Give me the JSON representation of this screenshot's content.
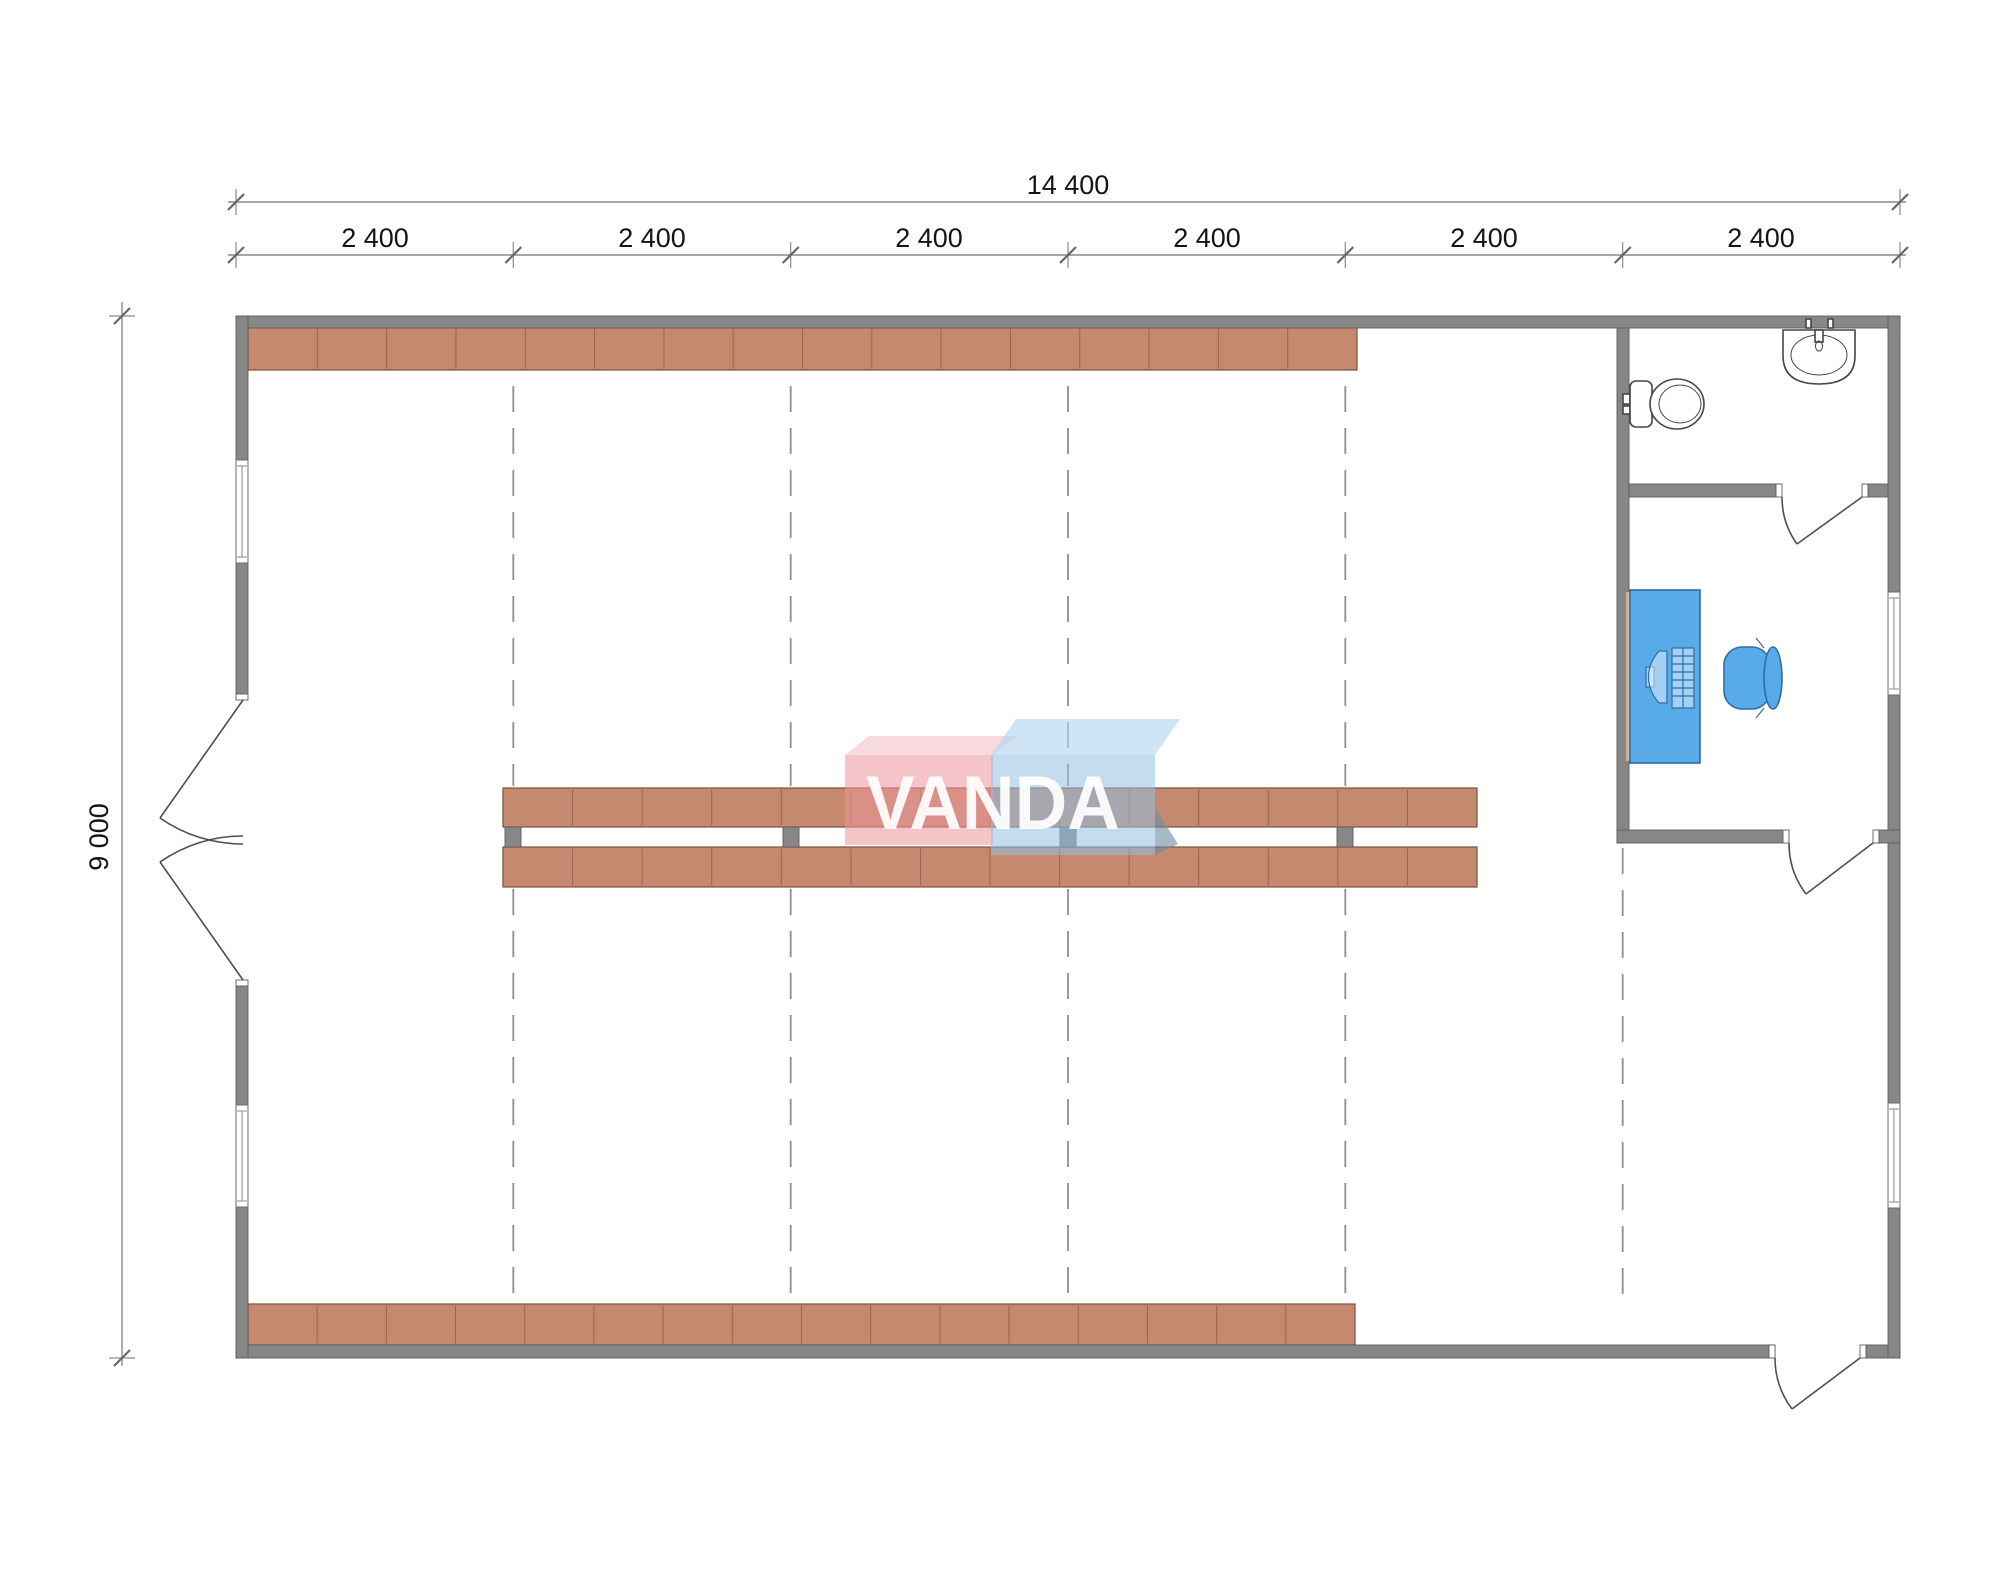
{
  "dimensions": {
    "overall_width_label": "14 400",
    "bay_labels": [
      "2 400",
      "2 400",
      "2 400",
      "2 400",
      "2 400",
      "2 400"
    ],
    "overall_height_label": "9 000"
  },
  "watermark": {
    "text": "VANDA"
  },
  "colors": {
    "wall": "#878787",
    "wall_outline": "#5d5d5d",
    "shelf_fill": "#c4896e",
    "shelf_outline": "#7d523a",
    "shelf_divider": "#9a644b",
    "furniture_blue": "#58aae9",
    "furniture_blue_outline": "#2f6da6",
    "gridline": "#909090",
    "dimension_line": "#8a8a8a",
    "dimension_text": "#141414",
    "fixture_outline": "#454545",
    "watermark_pink": "#ec949e",
    "watermark_blue": "#92c0e4",
    "watermark_text": "#ffffff"
  },
  "icons": {
    "toilet": "toilet-icon",
    "sink": "sink-icon",
    "desk": "desk",
    "chair": "office-chair",
    "shelving": "shelf-row",
    "double_door": "double-door",
    "single_door": "door-swing",
    "window": "window",
    "gridline": "structural-gridline"
  }
}
